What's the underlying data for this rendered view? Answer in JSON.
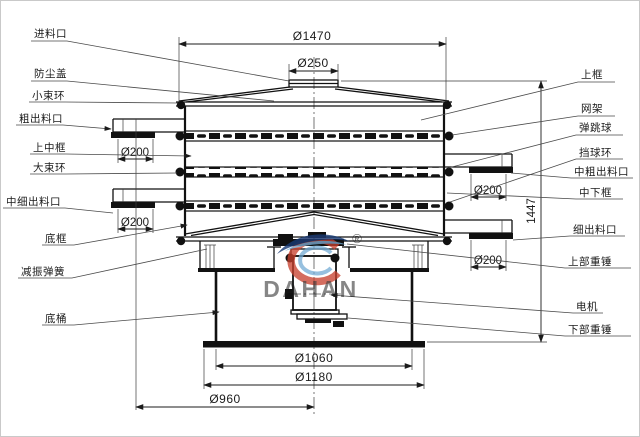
{
  "drawing": {
    "background": "#ffffff",
    "line_color": "#1b1b1b"
  },
  "labels": {
    "left": [
      {
        "id": "feed-inlet",
        "text": "进料口"
      },
      {
        "id": "dust-cover",
        "text": "防尘盖"
      },
      {
        "id": "small-clamp-ring",
        "text": "小束环"
      },
      {
        "id": "coarse-outlet",
        "text": "粗出料口"
      },
      {
        "id": "upper-middle-frame",
        "text": "上中框"
      },
      {
        "id": "large-clamp-ring",
        "text": "大束环"
      },
      {
        "id": "mid-fine-outlet",
        "text": "中细出料口"
      },
      {
        "id": "bottom-frame",
        "text": "底框"
      },
      {
        "id": "damping-spring",
        "text": "减振弹簧"
      },
      {
        "id": "base-barrel",
        "text": "底桶"
      }
    ],
    "right": [
      {
        "id": "upper-frame",
        "text": "上框"
      },
      {
        "id": "mesh-frame",
        "text": "网架"
      },
      {
        "id": "bouncing-ball",
        "text": "弹跳球"
      },
      {
        "id": "ball-stop-ring",
        "text": "挡球环"
      },
      {
        "id": "mid-coarse-outlet",
        "text": "中粗出料口"
      },
      {
        "id": "mid-lower-frame",
        "text": "中下框"
      },
      {
        "id": "fine-outlet",
        "text": "细出料口"
      },
      {
        "id": "upper-weight",
        "text": "上部重锤"
      },
      {
        "id": "motor",
        "text": "电机"
      },
      {
        "id": "lower-weight",
        "text": "下部重锤"
      }
    ]
  },
  "dimensions": {
    "top_diameter": "Ø1470",
    "inlet_diameter": "Ø250",
    "outlet_left_upper": "Ø200",
    "outlet_left_lower": "Ø200",
    "outlet_right_upper": "Ø200",
    "outlet_right_lower": "Ø200",
    "total_height": "1447",
    "barrel_diameter": "Ø1060",
    "base_diameter": "Ø1180",
    "outlet_circle": "Ø960"
  },
  "watermark": {
    "brand": "DAHAN",
    "registered": "®",
    "colors": {
      "red": "#c63f2e",
      "dark_blue": "#173a75",
      "light_blue": "#6fa8d2",
      "text_gray": "#9aa1a9"
    }
  }
}
